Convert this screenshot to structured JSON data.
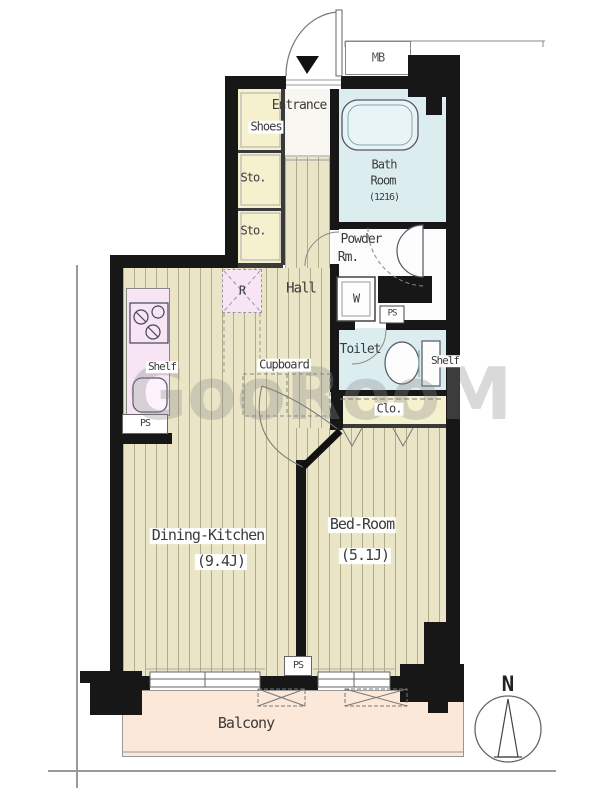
{
  "colors": {
    "wall": "#171717",
    "wood": "#eae5c7",
    "cream": "#f5f0cd",
    "wet": "#dcedf0",
    "pink": "#f7e4f4",
    "balcony": "#fbe8d9",
    "text": "#3b3b3b",
    "line": "#556066",
    "watermark": "#8a8a8a"
  },
  "labels": {
    "mb": "MB",
    "entrance": "Entrance",
    "shoes": "Shoes",
    "sto": "Sto.",
    "bath_l1": "Bath",
    "bath_l2": "Room",
    "bath_size": "(1216)",
    "powder_l1": "Powder",
    "powder_l2": "Rm.",
    "hall": "Hall",
    "washer": "W",
    "ps": "PS",
    "toilet": "Toilet",
    "shelf": "Shelf",
    "cupboard": "Cupboard",
    "fridge": "R",
    "closet": "Clo.",
    "dk_name": "Dining-Kitchen",
    "dk_size": "(9.4J)",
    "bed_name": "Bed-Room",
    "bed_size": "(5.1J)",
    "balcony": "Balcony",
    "compass_n": "N",
    "watermark": "GooRooM"
  }
}
